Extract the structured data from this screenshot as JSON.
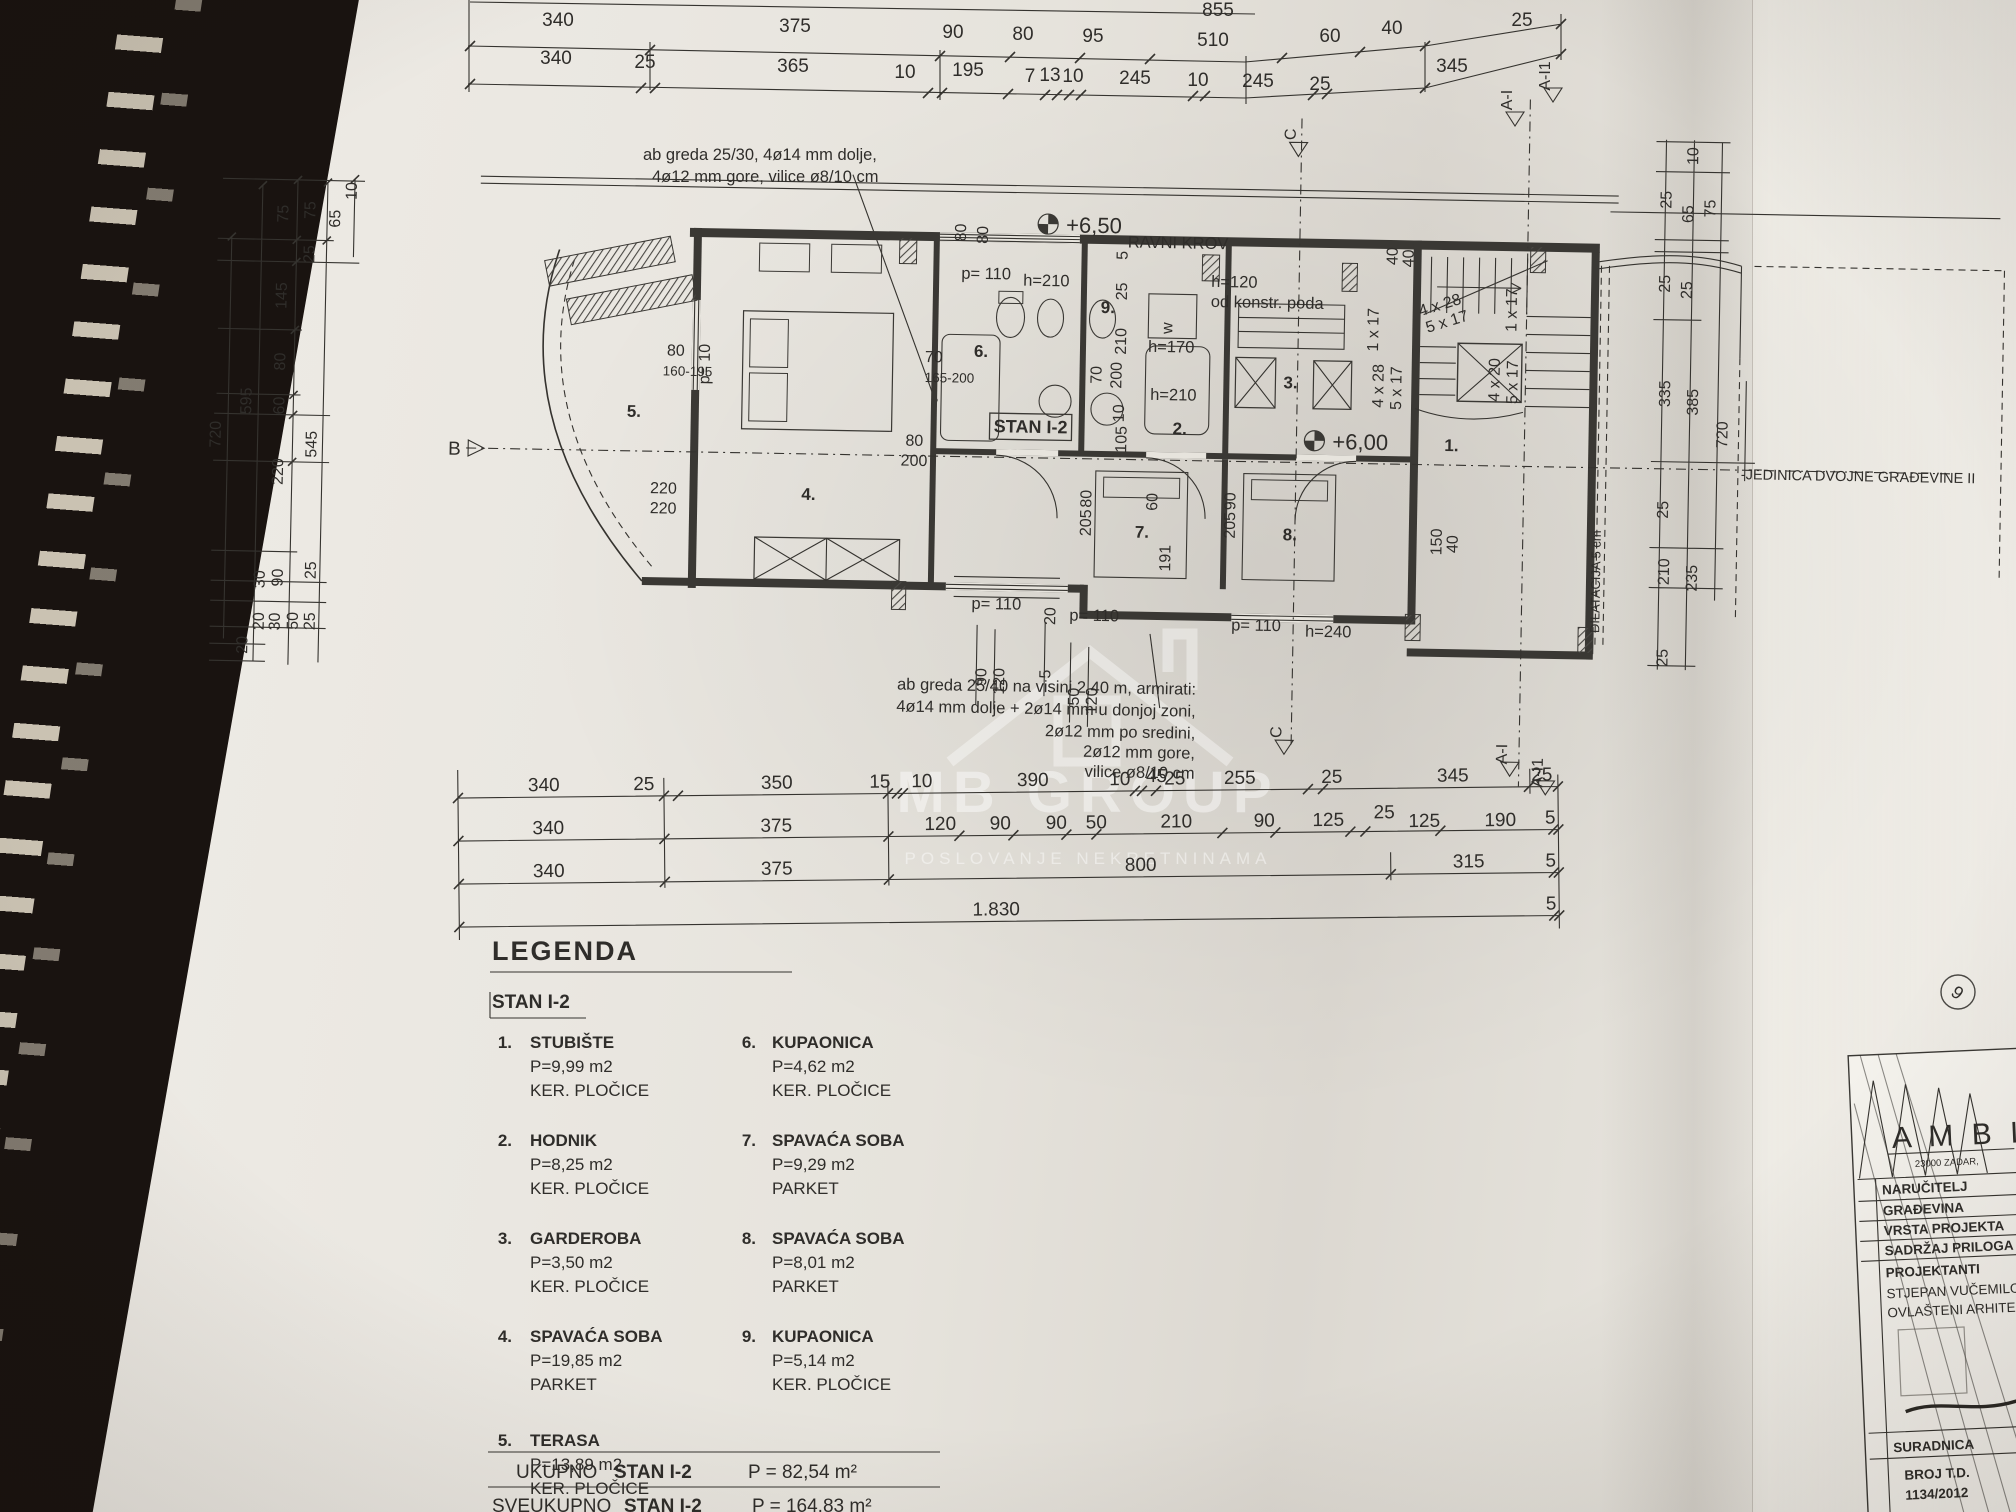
{
  "watermark": {
    "brand": "MB GROUP",
    "tagline": "POSLOVANJE NEKRETNINAMA"
  },
  "annotations": {
    "top_note_l1": "ab greda 25/30, 4ø14 mm dolje,",
    "top_note_l2": "4ø12 mm gore, vilice ø8/10 cm",
    "bottom_note_l1": "ab greda 25/40 na visini 2,40 m, armirati:",
    "bottom_note_l2": "4ø14 mm dolje + 2ø14 mm u donjoj zoni,",
    "bottom_note_l3": "2ø12 mm po sredini,",
    "bottom_note_l4": "2ø12 mm gore,",
    "bottom_note_l5": "vilice ø8/10 cm",
    "flat_roof": "RAVNI KROV",
    "level_upper": "+6,50",
    "level_main": "+6,00",
    "h120": "h=120",
    "h120b": "od konstr. poda",
    "h170": "h=170",
    "h210": "h=210",
    "h210b": "h=210",
    "h240": "h=240",
    "p110a": "p= 110",
    "p110b": "p= 110",
    "p110c": "p= 110",
    "p110d": "p= 110",
    "w_machine": "w",
    "range1": "160-195",
    "range2": "165-200",
    "p10": "p= 10",
    "dilatacija": "DILATACIJA 5 cm",
    "unit2": "-JEDINICA DVOJNE GRAĐEVINE II",
    "apartment": "STAN I-2",
    "dim45": "45"
  },
  "stairs": {
    "a": "4 x 28",
    "b": "5 x 17",
    "c": "1 x 17",
    "d": "4 x 28",
    "e": "5 x 17",
    "f": "4 x 20",
    "g": "5 x 17",
    "h": "1 x 17"
  },
  "markers": {
    "b": "B",
    "c_top": "C",
    "c_bot": "C",
    "a_top1": "A-I",
    "a_top2": "A-I1",
    "a_bot1": "A-I",
    "a_bot2": "A-I1",
    "sheet": "9"
  },
  "rooms": {
    "r1": "1.",
    "r2": "2.",
    "r3": "3.",
    "r4": "4.",
    "r5": "5.",
    "r6": "6.",
    "r7": "7.",
    "r8": "8.",
    "r9": "9."
  },
  "dims": {
    "top0": [
      "855"
    ],
    "top1": [
      "340",
      "375",
      "90",
      "80",
      "95",
      "510",
      "60",
      "40",
      "25"
    ],
    "top2": [
      "340",
      "25",
      "365",
      "10",
      "195",
      "7",
      "13",
      "10",
      "245",
      "10",
      "245",
      "25",
      "345"
    ],
    "left": [
      "10",
      "65",
      "75",
      "75",
      "25",
      "145",
      "80",
      "60",
      "595",
      "720",
      "545",
      "220",
      "90",
      "30",
      "25",
      "20",
      "30",
      "50",
      "25",
      "20"
    ],
    "right": [
      "10",
      "25",
      "65",
      "75",
      "25",
      "25",
      "335",
      "385",
      "720",
      "25",
      "210",
      "235",
      "25"
    ],
    "bottom1": [
      "340",
      "25",
      "350",
      "15",
      "10",
      "390",
      "10",
      "25",
      "255",
      "25",
      "345",
      "25"
    ],
    "bottom2": [
      "340",
      "375",
      "120",
      "90",
      "90",
      "50",
      "210",
      "90",
      "125",
      "25",
      "125",
      "190",
      "5"
    ],
    "bottom3": [
      "340",
      "375",
      "800",
      "315",
      "5"
    ],
    "bottom4": [
      "1.830",
      "5"
    ],
    "inner": {
      "w80a": "80",
      "w80b": "80",
      "v5": "5",
      "v25": "25",
      "v210": "210",
      "v70": "70",
      "v200": "200",
      "v10": "10",
      "v105": "105",
      "c80": "80",
      "c200": "200",
      "l220a": "220",
      "l220b": "220",
      "l80": "80",
      "s40a": "40",
      "s40b": "40",
      "s150": "150",
      "s40c": "40",
      "p80": "80",
      "p205a": "205",
      "p90": "90",
      "p205b": "205",
      "v60": "60",
      "v191": "191",
      "b20": "20",
      "b5": "5",
      "b90": "90",
      "b120a": "120",
      "b50": "50",
      "b120b": "120"
    }
  },
  "legend": {
    "title": "LEGENDA",
    "subtitle": "STAN I-2",
    "items": [
      {
        "num": "1.",
        "name": "STUBIŠTE",
        "area": "P=9,99 m2",
        "finish": "KER. PLOČICE"
      },
      {
        "num": "2.",
        "name": "HODNIK",
        "area": "P=8,25 m2",
        "finish": "KER. PLOČICE"
      },
      {
        "num": "3.",
        "name": "GARDEROBA",
        "area": "P=3,50 m2",
        "finish": "KER. PLOČICE"
      },
      {
        "num": "4.",
        "name": "SPAVAĆA SOBA",
        "area": "P=19,85 m2",
        "finish": "PARKET"
      },
      {
        "num": "5.",
        "name": "TERASA",
        "area": "P=13,89 m2",
        "finish": "KER. PLOČICE"
      },
      {
        "num": "6.",
        "name": "KUPAONICA",
        "area": "P=4,62 m2",
        "finish": "KER. PLOČICE"
      },
      {
        "num": "7.",
        "name": "SPAVAĆA SOBA",
        "area": "P=9,29 m2",
        "finish": "PARKET"
      },
      {
        "num": "8.",
        "name": "SPAVAĆA SOBA",
        "area": "P=8,01 m2",
        "finish": "PARKET"
      },
      {
        "num": "9.",
        "name": "KUPAONICA",
        "area": "P=5,14 m2",
        "finish": "KER. PLOČICE"
      }
    ],
    "totals": [
      {
        "label": "UKUPNO",
        "name": "STAN I-2",
        "value": "P = 82,54  m²"
      },
      {
        "label": "SVEUKUPNO",
        "name": "STAN I-2",
        "value": "P = 164,83  m²"
      },
      {
        "label": "UKUPNO",
        "name": "POTKROVLJE I",
        "value": "P = 82,54  m²"
      }
    ]
  },
  "titleblock": {
    "logo": "A M B I",
    "logo_sub": "23000 ZADAR,",
    "rows": [
      "NARUČITELJ",
      "GRAĐEVINA",
      "VRSTA PROJEKTA",
      "SADRŽAJ PRILOGA",
      "PROJEKTANTI",
      "STJEPAN VUČEMILO",
      "OVLAŠTENI ARHITE"
    ],
    "suradnica": "SURADNICA",
    "broj_td": "BROJ T.D.",
    "broj_val": "1134/2012"
  }
}
